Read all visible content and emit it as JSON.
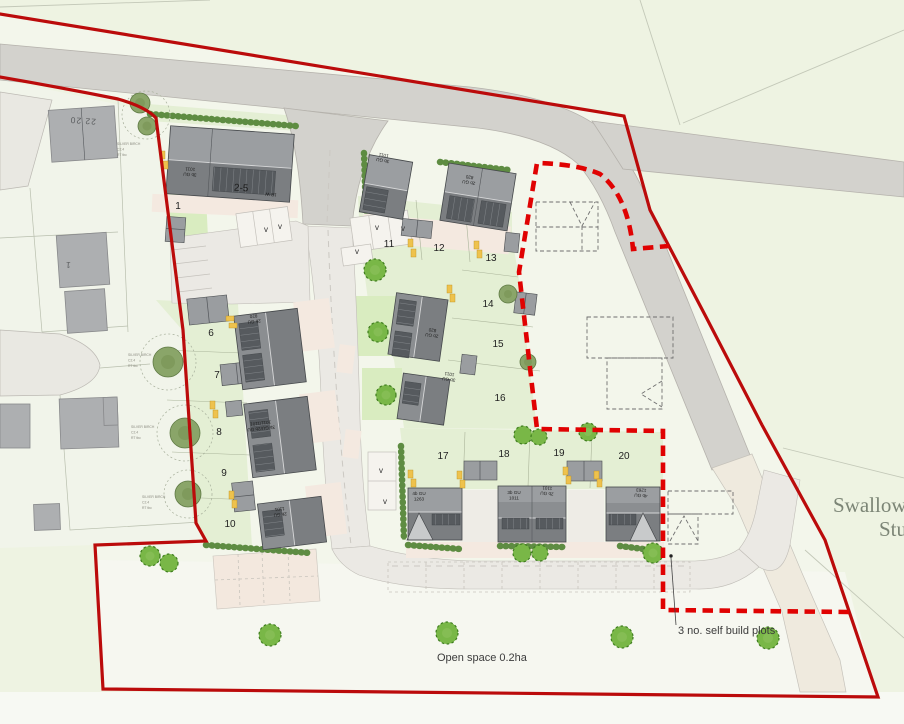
{
  "drawing": {
    "open_space_label": "Open space 0.2ha",
    "self_build_label": "3 no. self build plots",
    "place_name_line1": "Swallow F",
    "place_name_line2": "Stu"
  },
  "plot_numbers": [
    {
      "n": "1",
      "x": 178,
      "y": 209
    },
    {
      "n": "6",
      "x": 211,
      "y": 336
    },
    {
      "n": "7",
      "x": 217,
      "y": 378
    },
    {
      "n": "8",
      "x": 219,
      "y": 435
    },
    {
      "n": "9",
      "x": 224,
      "y": 476
    },
    {
      "n": "10",
      "x": 230,
      "y": 527
    },
    {
      "n": "11",
      "x": 389,
      "y": 247
    },
    {
      "n": "12",
      "x": 439,
      "y": 251
    },
    {
      "n": "13",
      "x": 491,
      "y": 261
    },
    {
      "n": "14",
      "x": 488,
      "y": 307
    },
    {
      "n": "15",
      "x": 498,
      "y": 347
    },
    {
      "n": "16",
      "x": 500,
      "y": 401
    },
    {
      "n": "17",
      "x": 443,
      "y": 459
    },
    {
      "n": "18",
      "x": 504,
      "y": 457
    },
    {
      "n": "19",
      "x": 559,
      "y": 456
    },
    {
      "n": "20",
      "x": 624,
      "y": 459
    }
  ],
  "visitor_bays": {
    "label": "v",
    "positions": [
      [
        266,
        232
      ],
      [
        280,
        229
      ],
      [
        377,
        230
      ],
      [
        403,
        231
      ],
      [
        357,
        254
      ],
      [
        381,
        473
      ],
      [
        385,
        504
      ]
    ]
  },
  "unit_labels": [
    {
      "lines": [
        "3b GU",
        "1011"
      ],
      "x": 190,
      "y": 173,
      "rot": 184,
      "big": false
    },
    {
      "lines": [
        "2-5"
      ],
      "x": 241,
      "y": 191,
      "rot": 3,
      "big": true
    },
    {
      "lines": [
        "1B W"
      ],
      "x": 271,
      "y": 193,
      "rot": 184,
      "big": false
    },
    {
      "lines": [
        "3b GU",
        "1011"
      ],
      "x": 383,
      "y": 159,
      "rot": 190,
      "big": false
    },
    {
      "lines": [
        "2b GU",
        "820"
      ],
      "x": 469,
      "y": 181,
      "rot": 189,
      "big": false
    },
    {
      "lines": [
        "2b GU",
        "820"
      ],
      "x": 254,
      "y": 320,
      "rot": 174,
      "big": false
    },
    {
      "lines": [
        "2b GU",
        "820"
      ],
      "x": 432,
      "y": 334,
      "rot": 188,
      "big": false
    },
    {
      "lines": [
        "3b GU",
        "1011"
      ],
      "x": 449,
      "y": 378,
      "rot": 188,
      "big": false
    },
    {
      "lines": [
        "3b GU/2b GU",
        "1011/1101"
      ],
      "x": 261,
      "y": 427,
      "rot": 174,
      "big": false
    },
    {
      "lines": [
        "2b GU",
        "1101"
      ],
      "x": 280,
      "y": 513,
      "rot": 174,
      "big": false
    },
    {
      "lines": [
        "4b GU",
        "1263"
      ],
      "x": 419,
      "y": 495,
      "rot": 0,
      "big": false
    },
    {
      "lines": [
        "3b GU",
        "1011"
      ],
      "x": 514,
      "y": 494,
      "rot": 0,
      "big": false
    },
    {
      "lines": [
        "2b GU",
        "1101"
      ],
      "x": 547,
      "y": 492,
      "rot": 184,
      "big": false
    },
    {
      "lines": [
        "4b GU",
        "1263"
      ],
      "x": 641,
      "y": 494,
      "rot": 184,
      "big": false
    }
  ],
  "existing_labels": [
    {
      "text": "22  20",
      "x": 83,
      "y": 118,
      "rot": 184
    },
    {
      "text": "1",
      "x": 68,
      "y": 262,
      "rot": 184
    }
  ],
  "tree_labels": {
    "lines": [
      "SILVER BIRCH",
      "C2.4",
      "RT tbc"
    ],
    "positions": [
      [
        117,
        145
      ],
      [
        128,
        356
      ],
      [
        131,
        428
      ],
      [
        142,
        498
      ]
    ]
  },
  "legend_colors": {
    "site_boundary": "#bb0b0b",
    "self_build_boundary": "#e00202",
    "proposed_tree": "#79b747",
    "building_roof": "#7b7e81",
    "main_road": "#d3d2cd"
  }
}
